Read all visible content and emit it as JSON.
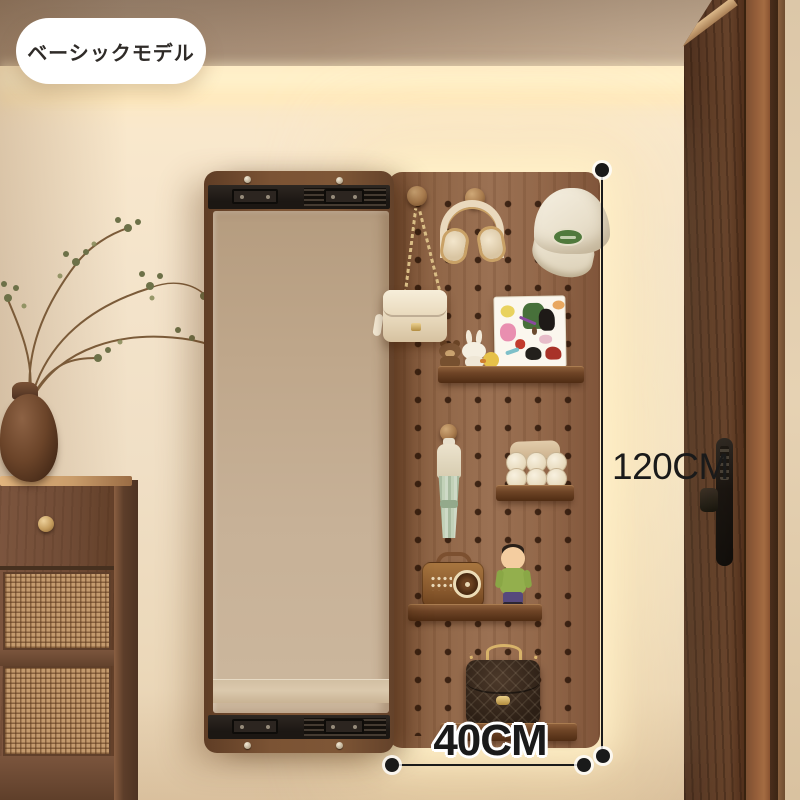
{
  "badge": {
    "label": "ベーシックモデル"
  },
  "annotations": {
    "height_label": "120CM",
    "width_label": "40CM"
  },
  "colors": {
    "badge_bg": "#ffffff",
    "badge_text": "#2f2b28",
    "annotation_ink": "#1a1a1a",
    "glow_warm": "#ffe9bd",
    "wall_cream": "#f3e3ca",
    "ceiling_taupe": "#a58e77",
    "pegboard_wood": "#926849",
    "shelf_walnut": "#6e4426",
    "mirror_glass": "#c4ab8f",
    "mirror_frame": "#74502f",
    "rail_black": "#221c17",
    "door_walnut": "#5d3c28",
    "cabinet_walnut": "#724e37",
    "rattan_cane": "#c39a6d",
    "brass_gold": "#cda45f",
    "cap_patch_green": "#50793c",
    "umbrella_mint": "#bfd1b8",
    "toy_shirt": "#93af4d"
  }
}
